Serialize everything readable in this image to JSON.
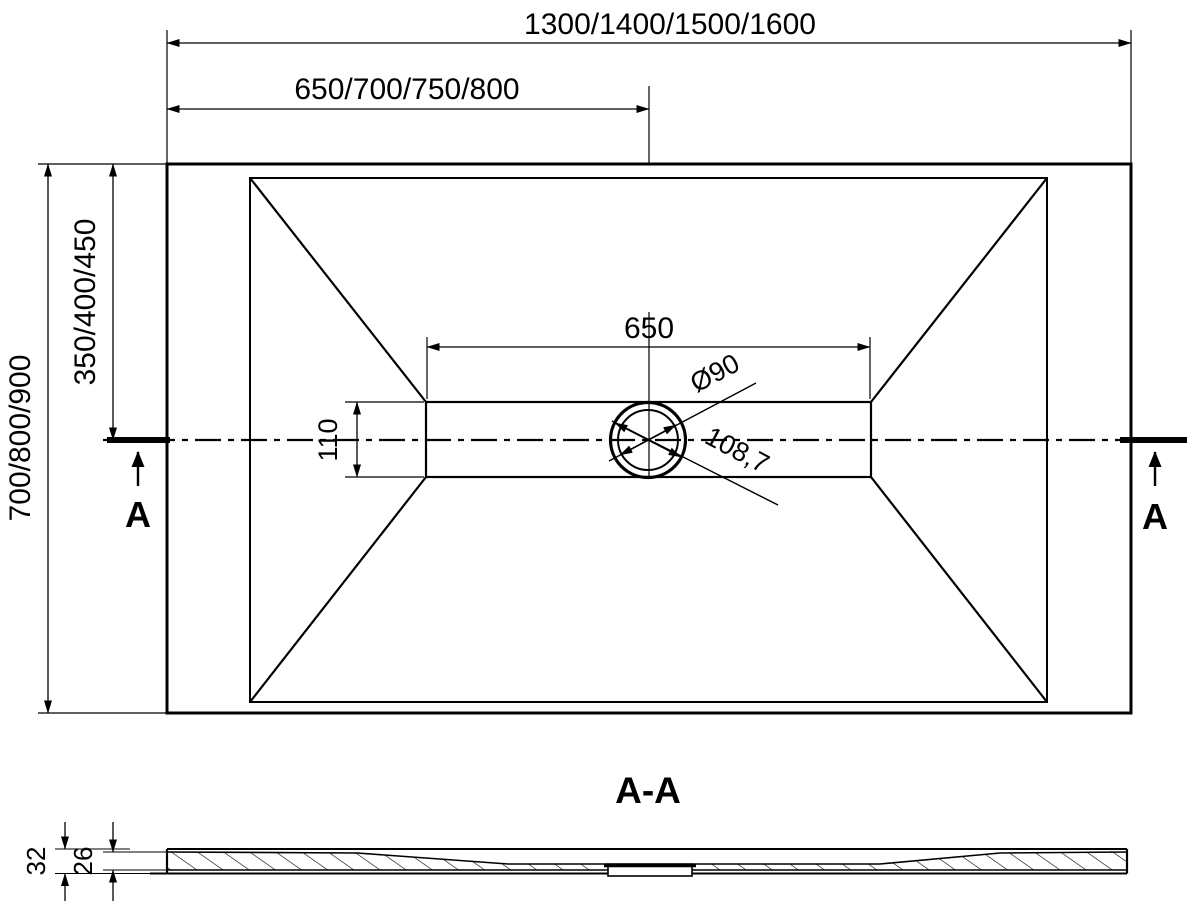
{
  "meta": {
    "background_color": "#ffffff",
    "line_color": "#000000",
    "drawing_type": "shower-tray-technical-drawing"
  },
  "plan_view": {
    "dim_overall_width": "1300/1400/1500/1600",
    "dim_center_offset": "650/700/750/800",
    "dim_overall_depth": "700/800/900",
    "dim_center_depth": "350/400/450",
    "dim_channel_length": "650",
    "dim_channel_width": "110",
    "dim_drain_diameter": "Ø90",
    "dim_drain_outer": "108,7",
    "section_label_left": "A",
    "section_label_right": "A"
  },
  "section_view": {
    "title": "A-A",
    "dim_total_height": "32",
    "dim_base_height": "26"
  }
}
